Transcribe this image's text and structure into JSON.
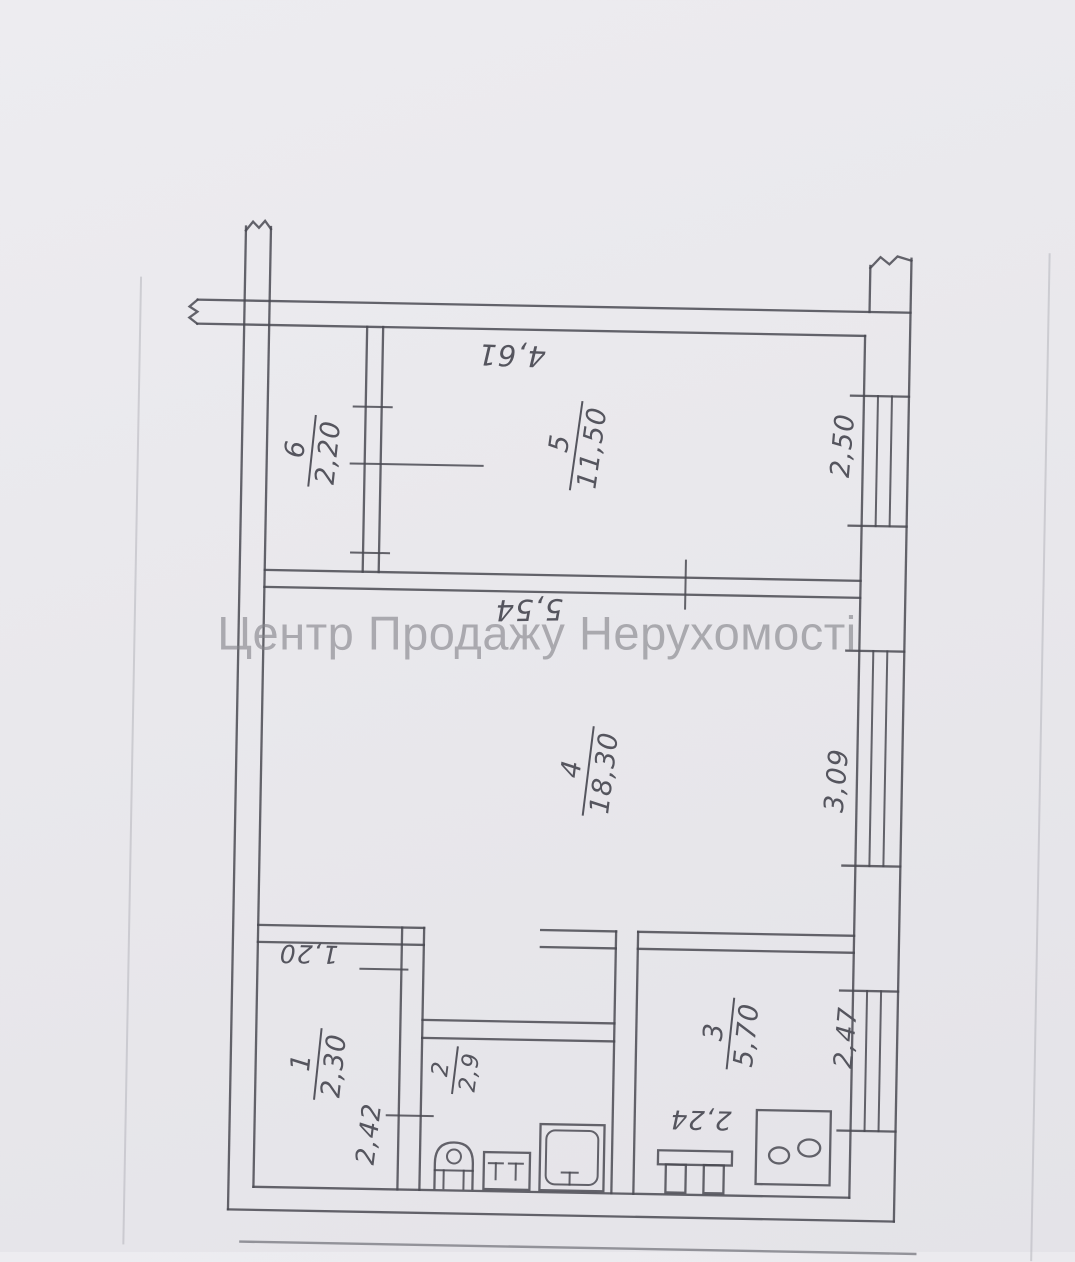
{
  "watermark": "Центр Продажу Нерухомості",
  "rooms": [
    {
      "number": "6",
      "area": "2,20"
    },
    {
      "number": "5",
      "area": "11,50"
    },
    {
      "number": "4",
      "area": "18,30"
    },
    {
      "number": "1",
      "area": "2,30"
    },
    {
      "number": "2",
      "area": "2,9"
    },
    {
      "number": "3",
      "area": "5,70"
    }
  ],
  "dimensions": {
    "top_width": "4,61",
    "middle_width": "5,54",
    "room5_depth": "2,50",
    "room4_depth": "3,09",
    "hall_width": "1,20",
    "hall_depth": "2,42",
    "kitchen_depth": "2,47",
    "kitchen_width": "2,24"
  },
  "colors": {
    "paper": "#e9e8ec",
    "ink": "#4a4a52",
    "watermark": "#84848a"
  }
}
